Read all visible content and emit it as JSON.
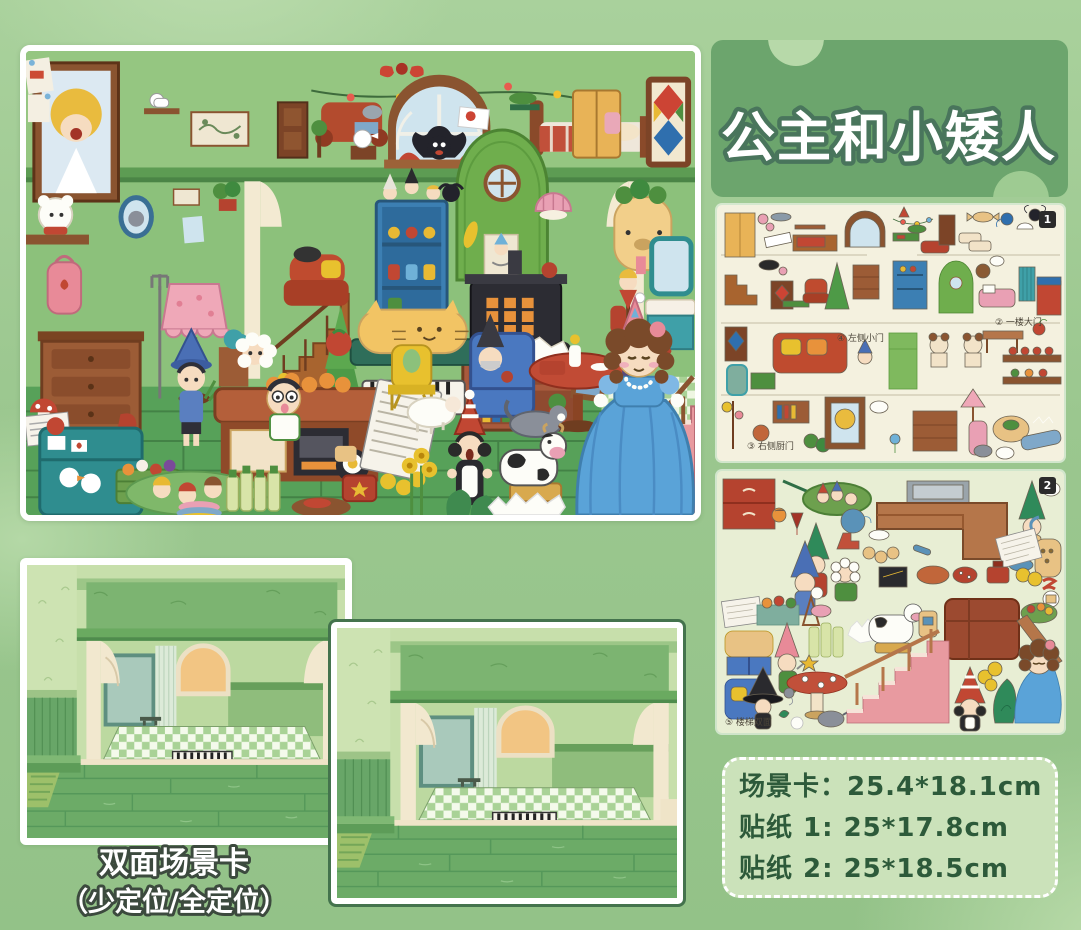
{
  "title": {
    "text": "公主和小矮人"
  },
  "sheet1": {
    "badge": "1",
    "label_left_door": "④ 左侧小门",
    "label_main_door": "② 一楼大门",
    "label_right_door": "③ 右侧厨门"
  },
  "sheet2": {
    "badge": "2",
    "label_stairs": "⑤ 楼梯双面"
  },
  "scene_cards": {
    "caption_line1": "双面场景卡",
    "caption_line2": "（少定位/全定位）"
  },
  "specs": {
    "card_size": "场景卡：25.4*18.1cm",
    "sticker1_size": "贴纸 1: 25*17.8cm",
    "sticker2_size": "贴纸 2: 25*18.5cm"
  },
  "colors": {
    "background": "#9bc78f",
    "banner": "#6ca56d",
    "banner_text": "#ffffff",
    "banner_text_outline": "#49755c",
    "sheet1_bg": "#f4f1df",
    "sheet2_bg": "#e8eed4",
    "specs_panel": "#cbe2ba",
    "specs_text": "#2d5a3a",
    "card_border_dark": "#44734d"
  }
}
